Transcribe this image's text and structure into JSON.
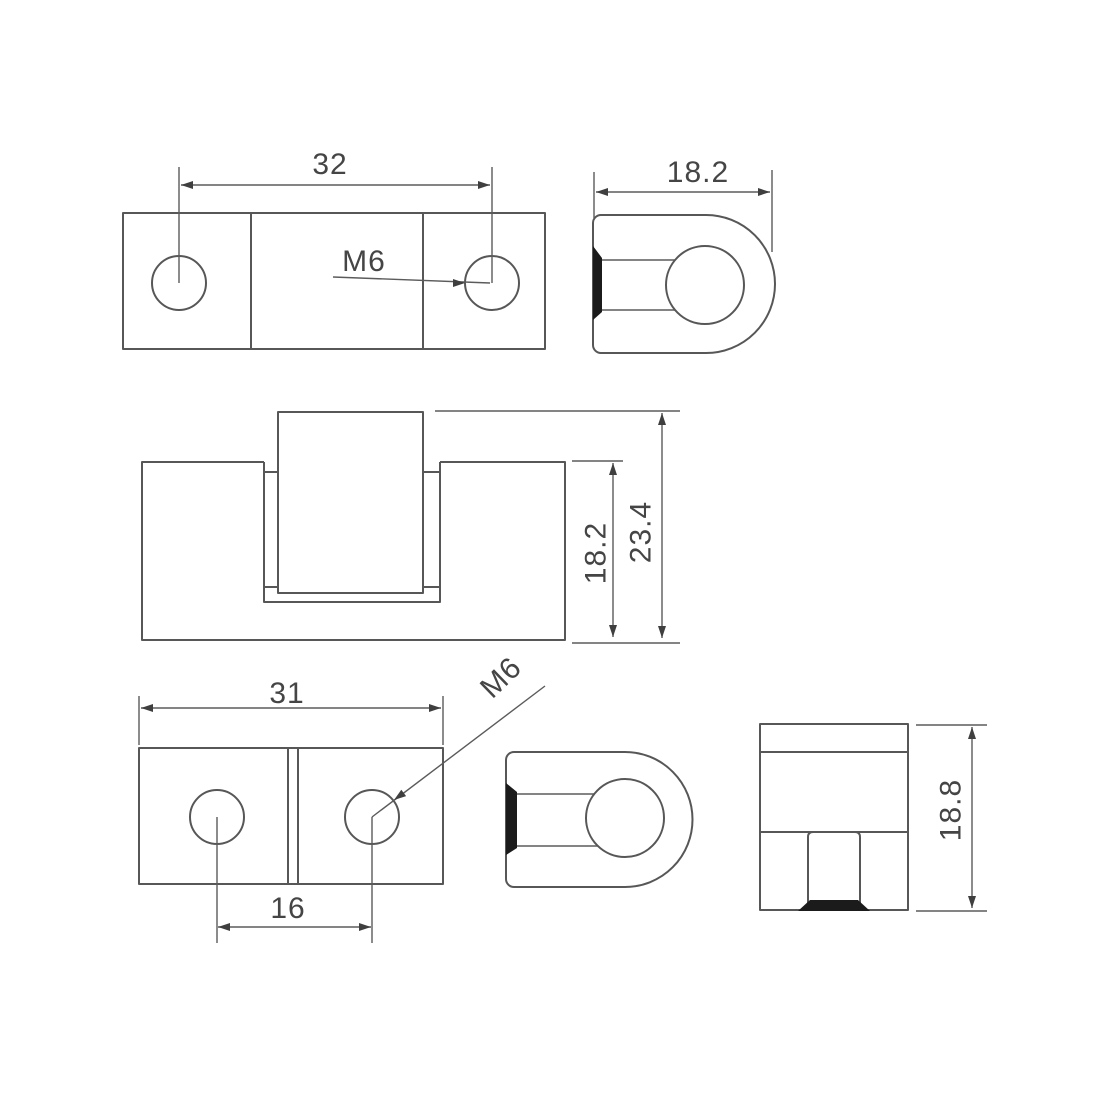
{
  "drawing": {
    "type": "engineering-multi-view-drawing",
    "background": "#ffffff",
    "line_color": "#575757",
    "dark_fill_color": "#1b1b1b",
    "text_color": "#454545",
    "views": {
      "top_plate": {
        "description": "top view of upper hinge leaf with two holes",
        "dim_hole_spacing": "32",
        "thread_label": "M6"
      },
      "top_end": {
        "description": "end view (D-shape) of upper hinge leaf",
        "dim_width": "18.2"
      },
      "front": {
        "description": "front view of assembled hinge",
        "dim_body_height": "18.2",
        "dim_total_height": "23.4"
      },
      "bottom_plate": {
        "description": "top view of lower hinge leaf with two holes",
        "dim_width": "31",
        "dim_hole_spacing": "16",
        "thread_label": "M6"
      },
      "bottom_end": {
        "description": "end view (D-shape) of lower hinge leaf"
      },
      "side": {
        "description": "side view of hinge block with slot",
        "dim_height": "18.8"
      }
    }
  }
}
